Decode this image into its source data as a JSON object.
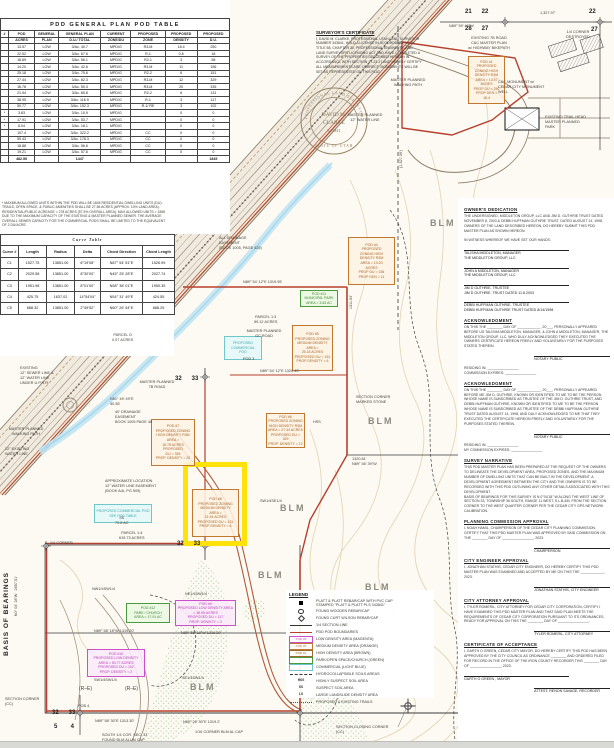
{
  "colors": {
    "boundary_red": "#b6402e",
    "orange": "#c07830",
    "magenta": "#cb4fcb",
    "green": "#4a9a40",
    "cyan": "#6fc7cc",
    "highlight_yellow": "#ffe20a",
    "blm_gray": "#8b8b80"
  },
  "pod_table": {
    "title": "PDD GENERAL PLAN POD TABLE",
    "header_rows": [
      [
        "#",
        "POD",
        "GENERAL",
        "GENERAL PLAN",
        "CURRENT",
        "PROPOSED",
        "PROPOSED",
        "PROPOSED"
      ],
      [
        "",
        "ACRES",
        "PLAN",
        "D.U./ TOTAL",
        "ZONE/DU",
        "ZONE",
        "DENSITY",
        "D.U."
      ]
    ],
    "rows": [
      [
        "",
        "13.57",
        "LOW",
        "3/Ac.  40.7",
        "MPD/G",
        "R3-M",
        "18.4",
        "250"
      ],
      [
        "",
        "22.52",
        "LOW",
        "3/Ac.  67.6",
        "MPD/G",
        "R-1",
        "0.8",
        "18"
      ],
      [
        "",
        "18.69",
        "LOW",
        "3/Ac.  56.1",
        "MPD/G",
        "R2-1",
        "3",
        "58"
      ],
      [
        "",
        "14.20",
        "LOW",
        "3/Ac.  42.6",
        "MPD/G",
        "R3-M",
        "11",
        "156"
      ],
      [
        "",
        "25.18",
        "LOW",
        "3/Ac.  75.6",
        "MPD/G",
        "R2-2",
        "6",
        "151"
      ],
      [
        "",
        "27.44",
        "LOW",
        "3/Ac.  82.3",
        "MPD/G",
        "R3-M",
        "12",
        "329"
      ],
      [
        "",
        "16.78",
        "LOW",
        "3/Ac.  50.3",
        "MPD/G",
        "R3-M",
        "20",
        "335"
      ],
      [
        "",
        "21.94",
        "LOW",
        "3/Ac.  65.8",
        "MPD/G",
        "R2-2",
        "6",
        "131"
      ],
      [
        "",
        "38.95",
        "LOW",
        "3/Ac.  116.9",
        "MPD/G",
        "R-1",
        "3",
        "117"
      ],
      [
        "",
        "50.77",
        "LOW",
        "3/Ac.  152.3",
        "MPD/G",
        "R-1/ RE",
        "3",
        "102"
      ],
      [
        "*",
        "3.63",
        "LOW",
        "3/Ac.  10.9",
        "MPD/G",
        "",
        "0",
        "0"
      ],
      [
        "*",
        "17.91",
        "LOW",
        "3/Ac.  53.7",
        "MPD/G",
        "",
        "0",
        "0"
      ],
      [
        "*",
        "6.04",
        "LOW",
        "3/Ac.  18.1",
        "MPD/G",
        "",
        "0",
        "0"
      ],
      [
        "",
        "107.4",
        "LOW",
        "3/Ac.  322.2",
        "MPD/G",
        "CC",
        "0",
        "0"
      ],
      [
        "",
        "59.43",
        "LOW",
        "3/Ac.  178.3",
        "MPD/G",
        "CC",
        "0",
        "0"
      ],
      [
        "",
        "18.88",
        "LOW",
        "3/Ac.  56.6",
        "MPD/G",
        "CC",
        "0",
        "0"
      ],
      [
        "",
        "19.21",
        "LOW",
        "3/Ac.  57.6",
        "MPD/G",
        "CC",
        "0",
        "0"
      ]
    ],
    "total": [
      "",
      "482.55",
      "",
      "1447",
      "",
      "",
      "",
      "1845"
    ],
    "footnote": "* MAXIMUM ALLOWED UNITS WITHIN THE PDD WILL BE 1845 RESIDENTIAL DWELLING UNITS (DU).\nTRAILS, OPEN SPACE, & PUBLIC AMENITIES SHALL BE 27.56 ACRES (APPROX. 10% LAND AREA).\nRESIDENTIAL/PUBLIC ACREAGE = 278 ACRES (57.5% OVERALL AREA). MAX ALLOWED UNITS = 1558\nDUE TO THE MAXIMUM CAPACITY OF THE EXISTING & MASTER PLANNED SEWER. THE AVERAGE\nOVERALL SEWER CAPACITY FOR THE COMMERCIAL PODS SHALL BE LIMITED TO THE EQUIVALENT\nOF 2 DU/ACRE."
  },
  "curve_table": {
    "title": "Curve Table",
    "header_rows": [
      [
        "Curve #",
        "Length",
        "Radius",
        "Delta",
        "Chord Direction",
        "Chord Length"
      ]
    ],
    "rows": [
      [
        "C1",
        "1527.75",
        "13851.00",
        "6°19'08\"",
        "N87° 54' 51\"E",
        "1526.99"
      ],
      [
        "C2",
        "2029.58",
        "13851.00",
        "8°30'00\"",
        "N45° 25' 28\"E",
        "2027.74"
      ],
      [
        "C3",
        "1951.98",
        "13851.00",
        "8°01'00\"",
        "N58° 38' 01\"E",
        "1950.35"
      ],
      [
        "C4",
        "425.75",
        "1637.02",
        "14°54'04\"",
        "N54° 31' 49\"E",
        "424.55"
      ],
      [
        "C5",
        "688.32",
        "13851.00",
        "2°49'52\"",
        "N60° 26' 54\"E",
        "688.25"
      ]
    ]
  },
  "surveyor": {
    "title": "SURVEYOR'S CERTIFICATE",
    "body": "I, DAVID M. CLARKE, PROFESSIONAL UTAH LAND SURVEYOR NUMBER 343841, HOLD A LICENSE IN ACCORDANCE WITH TITLE 58, CHAPTER 22, PROFESSIONAL ENGINEERS AND LAND SURVEYORS LICENSING ACT AND HAVE COMPLETED A SURVEY OF THE PROPERTIES DESCRIBED HEREON IN ACCORDANCE WITH SECTION 17-23-17 AND HEREBY CERTIFY ALL MEASUREMENTS ARE CORRECT. MONUMENTS WILL BE SET AS REPRESENTED ON THIS PLAT.",
    "seal": {
      "name1": "DAVID M.",
      "name2": "CLARKE",
      "number": "343841",
      "ring_top": "PROFESSIONAL LAND SURVEYOR",
      "ring_bottom": "STATE OF UTAH"
    }
  },
  "certificates": {
    "blocks": [
      {
        "title": "OWNER'S DEDICATION",
        "body": "THE UNDERSIGNED, MIDDLETON GROUP, LLC AND JIM D. GUTHRIE TRUST DATED NOVEMBER 8, 2003 & DEBBI HUFFMAN GUTHRIE TRUST, DATED AUGUST 14, 1998, OWNERS OF THE LAND DESCRIBED HEREON, DO HEREBY SUBMIT THIS PDD MASTER PLAN AS SHOWN HEREON.\n\nIN WITNESS WHEREOF WE HAVE SET OUR HANDS:",
        "sigs": [
          {
            "name": "TALISHA MIDDLETON, MANAGER",
            "sub": "THE MIDDLETON GROUP, LLC",
            "align": "left"
          },
          {
            "name": "JOHN A MIDDLETON, MANAGER",
            "sub": "THE MIDDLETON GROUP, LLC",
            "align": "left"
          },
          {
            "name": "JIM D GUTHRIE, TRUSTEE",
            "sub": "JIM D GUTHRIE, TRUST DATED 11.8.2003",
            "align": "left"
          },
          {
            "name": "DEBBI HUFFMAN GUTHRIE, TRUSTEE",
            "sub": "DEBBI HUFFMAN GUTHRIE TRUST DATED 8/14/1998",
            "align": "left"
          }
        ]
      },
      {
        "title": "ACKNOWLEDGMENT",
        "body": "ON THIS THE ________ DAY OF ____________, 20___, PERSONALLY APPEARED BEFORE US TALISHA MIDDLETON, MANAGER, & JOHN A MIDDLETON, MANAGER, THE MIDDLETON GROUP, LLC, WHO DULY ACKNOWLEDGED THEY EXECUTED THE OWNERS CERTIFICATE HEREON FREELY AND VOLUNTARILY FOR THE PURPOSES STATED THEREIN.",
        "sigs": [
          {
            "name": "NOTARY PUBLIC",
            "sub": "",
            "align": "right"
          }
        ],
        "after": "RESIDING IN: ________________\nCOMMISSION EXPIRES: ________________"
      },
      {
        "title": "ACKNOWLEDGMENT",
        "body": "ON THIS THE ________ DAY OF ____________, 20___, PERSONALLY APPEARED BEFORE ME JIM D. GUTHRIE, KNOWN OR IDENTIFIED TO ME TO BE THE PERSON WHOSE NAME IS SUBSCRIBED AS TRUSTEE OF THE JIM D. GUTHRIE TRUST, AND DEBBI HUFFMAN GUTHRIE, KNOWN OR IDENTIFIED TO ME TO BE THE PERSON WHOSE NAME IS SUBSCRIBED AS TRUSTEE OF THE DEBBI HUFFMAN GUTHRIE TRUST DATED AUGUST 14, 1998, AND DULY ACKNOWLEDGED TO ME THAT THEY EXECUTED THE CERTIFICATE HEREON FREELY AND VOLUNTARILY FOR THE PURPOSES STATED THEREIN.",
        "sigs": [
          {
            "name": "NOTARY PUBLIC",
            "sub": "",
            "align": "right"
          }
        ],
        "after": "RESIDING IN: ________________\nMY COMMISSION EXPIRES: ________________"
      },
      {
        "title": "SURVEY NARRATIVE",
        "body": "THIS PDD MASTER PLAN HAS BEEN PREPARED AT THE REQUEST OF THE OWNERS TO DELINEATE THE DEVELOPMENT AREA, PROPOSED ZONES, AND THE MAXIMUM NUMBER OF DWELLING UNITS THAT CAN BE BUILT IN THE DEVELOPMENT. A DEVELOPMENT AGREEMENT BETWEEN THE CITY AND THE OWNERS IS TO BE RECORDED WITH THIS PDD OUTLINING ANY OTHER DETAILS ASSOCIATED WITH THIS DEVELOPMENT.\nBASIS OF BEARINGS FOR THIS SURVEY IS N 0°04'18\" W ALONG THE WEST LINE OF SECTION 33, TOWNSHIP 36 SOUTH, RANGE 11 WEST, S.L.B.&M. FROM THE SECTION CORNER TO THE WEST QUARTER CORNER PER THE CEDAR CITY GPS NETWORK CALIBRATION.",
        "sigs": []
      },
      {
        "title": "PLANNING COMMISSION APPROVAL",
        "body": "I, NOAH HAMIL, CHAIRPERSON OF THE CEDAR CITY PLANNING COMMISSION, CERTIFY THAT THIS PDD MASTER PLAN WAS APPROVED BY SAID COMMISSION ON THE ________ DAY OF ________________, 2023.",
        "sigs": [
          {
            "name": "CHAIRPERSON",
            "sub": "",
            "align": "right"
          }
        ]
      },
      {
        "title": "CITY ENGINEER APPROVAL",
        "body": "I, JONATHAN STATHIS, CEDAR CITY ENGINEER, DO HEREBY CERTIFY THIS PDD MASTER PLAN WAS EXAMINED AND ACCEPTED BY ME ON THIS THE ____________, 2023.",
        "sigs": [
          {
            "name": "JONATHAN STATHIS, CITY ENGINEER",
            "sub": "",
            "align": "right"
          }
        ]
      },
      {
        "title": "CITY ATTORNEY APPROVAL",
        "body": "I, TYLER ROMERIL, CITY ATTORNEY FOR CEDAR CITY CORPORATION, CERTIFY I HAVE EXAMINED THIS PDD MASTER PLAN AND THAT SAID PLAN MEETS THE REQUIREMENTS OF CEDAR CITY CORPORATION PURSUANT TO ITS ORDINANCES, READY FOR APPROVAL ON THIS THE ________ DAY OF ________________.",
        "sigs": [
          {
            "name": "TYLER ROMERIL, CITY ATTORNEY",
            "sub": "",
            "align": "right"
          }
        ]
      },
      {
        "title": "CERTIFICATE OF ACCEPTANCE",
        "body": "I, GARTH O GREEN, CEDAR CITY MAYOR, DO HEREBY CERTIFY THIS PDD HAS BEEN APPROVED BY THE CITY COUNCIL AS ORDINANCE ________ AND ORDERED FILED FOR RECORD IN THE OFFICE OF THE IRON COUNTY RECORDER THIS ________ DAY OF ________________, 2023.",
        "sigs": [
          {
            "name": "GARTH O GREEN , MAYOR",
            "sub": "",
            "align": "left"
          },
          {
            "name": "ATTEST:  RENON SAVAGE, RECORDER",
            "sub": "",
            "align": "right"
          }
        ]
      }
    ]
  },
  "legend": {
    "title": "LEGEND",
    "items": [
      {
        "sym": "sq",
        "tag": "",
        "label": "PLATT & PLATT REBAR/CAP WITH PVC CAP\nSTAMPED \"PLATT & PLATT PLS 343841\""
      },
      {
        "sym": "circle",
        "tag": "",
        "label": "FOUND WOODEN REBAR/CAP"
      },
      {
        "sym": "diamond",
        "tag": "",
        "label": "FOUND CURT WILSON REBAR/CAP"
      },
      {
        "sym": "line",
        "tag": "",
        "label": "1/4 SECTION LINE"
      },
      {
        "sym": "redline",
        "tag": "",
        "label": "PDD POD BOUNDARIES"
      },
      {
        "sym": "box",
        "color": "#cb4fcb",
        "tag": "POD #9",
        "label": "LOW DENSITY AREA (MAGENTA)"
      },
      {
        "sym": "box",
        "color": "#c07830",
        "tag": "POD #5",
        "label": "MEDIUM DENSITY AREA (ORANGE)"
      },
      {
        "sym": "box",
        "color": "#9a6a30",
        "tag": "POD #1",
        "label": "HIGH DENSITY AREA (BROWN)"
      },
      {
        "sym": "box",
        "color": "#4a9a40",
        "tag": "",
        "label": "PARK/OPEN SPACE/CHURCH (GREEN)"
      },
      {
        "sym": "box",
        "color": "#6fc7cc",
        "tag": "",
        "label": "COMMERCIAL (LIGHT BLUE)"
      },
      {
        "sym": "dash",
        "tag": "",
        "label": "HYDROCOLLAPSIBLE SOILS AREAS"
      },
      {
        "sym": "text",
        "tag": "HSS",
        "label": "HIGHLY SUSPECT SOIL AREA"
      },
      {
        "sym": "text",
        "tag": "SS",
        "label": "SUSPECT SOIL AREA"
      },
      {
        "sym": "text",
        "tag": "LS",
        "label": "LARGE LANDSLIDE DENSITY AREA"
      },
      {
        "sym": "dots",
        "tag": "",
        "label": "PROPOSED & EXISTING TRAILS"
      }
    ]
  },
  "map": {
    "pods": {
      "p1": "POD #1\nPROPOSED\nZONING HIGH\nDENSITY R3M\nAREA = 13.57\nACRES\nPROP DU = 250\nPROP DEN =\n18.4",
      "p4": "POD #4\nPROPOSED\nZONING HIGH\nDENSITY R3M\nAREA = 14.20\nACRES\nPROP DU = 156\nPROP DEN = 11",
      "p5": "POD #5\nPROPOSED ZONING\nMEDIUM DENSITY\nAREA =\n25.18 ACRES\nPROPOSED DU = 151\nPROP DENSITY = 6",
      "p6": "POD #6\nPROPOSED ZONING\nHIGH DENSITY R3M\nAREA = 27.44 ACRES\nPROPOSED DU = 329\nPROP. DENSITY = 12",
      "p7": "POD #7\nPROPOSED ZONING\nHIGH DENSITY R3M\nAREA =\n16.78 ACRES\nPROPOSED\nDU = 335\nPROP. DENSITY = 20",
      "p8": "POD #8\nPROPOSED ZONING\nMEDIUM DENSITY\nAREA =\n21.94 ACRES\nPROPOSED DU = 131\nPROP DENSITY = 6",
      "p9": "POD #9\nPROPOSED LOW DENSITY AREA\n= 38.95 ACRES\nPROPOSED DU = 117\nPROP. DENSITY = 3",
      "p10": "POD #10\nPROPOSED LOW DENSITY\nAREA = 50.77 ACRES\nPROPOSED DU = 102\nPROP. DENSITY = 2",
      "p11": "POD #11\nMUNICIPAL PARK\nAREA = 3.63 AC",
      "p12": "POD #12\nPARK / CHURCH\nAREA = 17.91 AC",
      "p14": "PROPOSED\nCOMMERCIAL\nPOD",
      "p15": "PROPOSED COMMERCIAL POD\nSEE POD TABLE"
    },
    "labels": {
      "t2122": "21      22",
      "t2827": "28      27",
      "t22": "22",
      "t27": "27",
      "dtop": "1,327.97'",
      "btop": "N89° 59' 40\"W",
      "qdest": "1/4 CORNER\nDESTROYED",
      "road7b": "EXISTING 7B ROAD\nC&C MASTER PLAN\nw/ HIGHWAY BIKEPATH",
      "ccmon": "C&C MONUMENT w/\nCEDAR CITY MONUMENT WELL",
      "walk": "MASTER PLANNED\nWALKING PATH",
      "watne": "MASTER PLANNED\n12\" WATER LINE",
      "trailhead": "EXISTING TRAIL HEAD\nMASTER PLANNED\nPARK",
      "blm": "BLM",
      "drain1": "ALL DRAINAGE EASEMENT\n(BOOK 1005, PAGE 425)",
      "b287": "N89° 54' 12\"E      1319.95'",
      "parcel13": "PARCEL 1:3\n59.12 ACRES",
      "parceld": "PARCEL D\n0.07 ACRES",
      "gcroad": "MASTER PLANNED\nGC ROAD",
      "pod3": "POD 3",
      "b375": "N89° 54' 12\"E   1320.40'",
      "d1311": "1311.04'",
      "stone": "SECTION CORNER\nMARKED STONE",
      "hss": "HSS",
      "d1320": "1320.81'\nN89° 46' 39\"W",
      "m7b": "MASTER PLANNED\n7B ROAD",
      "n51": "N51° 49' 49\"E\n50.35'",
      "drain2": "40' DRAINAGE EASEMENT\nBOOK 1005 PAGE 48",
      "sewer": "EXISTING\n12\" SEWER LINE &\n12\" WATER LINE\nUNDER U.P.R.R.",
      "t3233": "32      33",
      "watex": "12\" EXISTING\nWATER LINE",
      "approx": "APPROXIMATE LOCATION\n12\" WATER LINE EASEMENT\n(BOOK A/A, PG 509)",
      "ss708": "SS\n70.8 AC",
      "parcel14": "PARCEL 1:4\n615.73 ACRES",
      "qcor": "1/4 CORNER",
      "sw14se": "SW1/4SE1/4",
      "nw14sw": "NW1/4SW1/4",
      "ne14sw": "NE1/4SW1/4",
      "b633a": "N89° 58' 18\"W   1319.20'",
      "b633b": "N89° 55' 18\"W   1319.20'",
      "sw14sw": "SW1/4SW1/4",
      "se14sw": "SE1/4SW1/4",
      "re": "(R–E)",
      "pob4": "POB 4",
      "t54": "5        4",
      "bb1": "N89° 58' 30\"E   1313.30'",
      "bb2": "N89° 26' 30\"E   1319.2'",
      "c116": "1/16 CORNER BLM AL CAP",
      "s14": "SOUTH 1/4 COR. SEC. 33\nFOUND BLM ALUM CAP",
      "seccc": "SECTION CORNER\n(CC)",
      "closing": "SECTION CLOSING CORNER\n(CC)",
      "basis": "BASIS OF BEARINGS",
      "basisb": "N0° 04' 18\"W   2657.51'",
      "d1327": "(1,327.39')"
    }
  }
}
